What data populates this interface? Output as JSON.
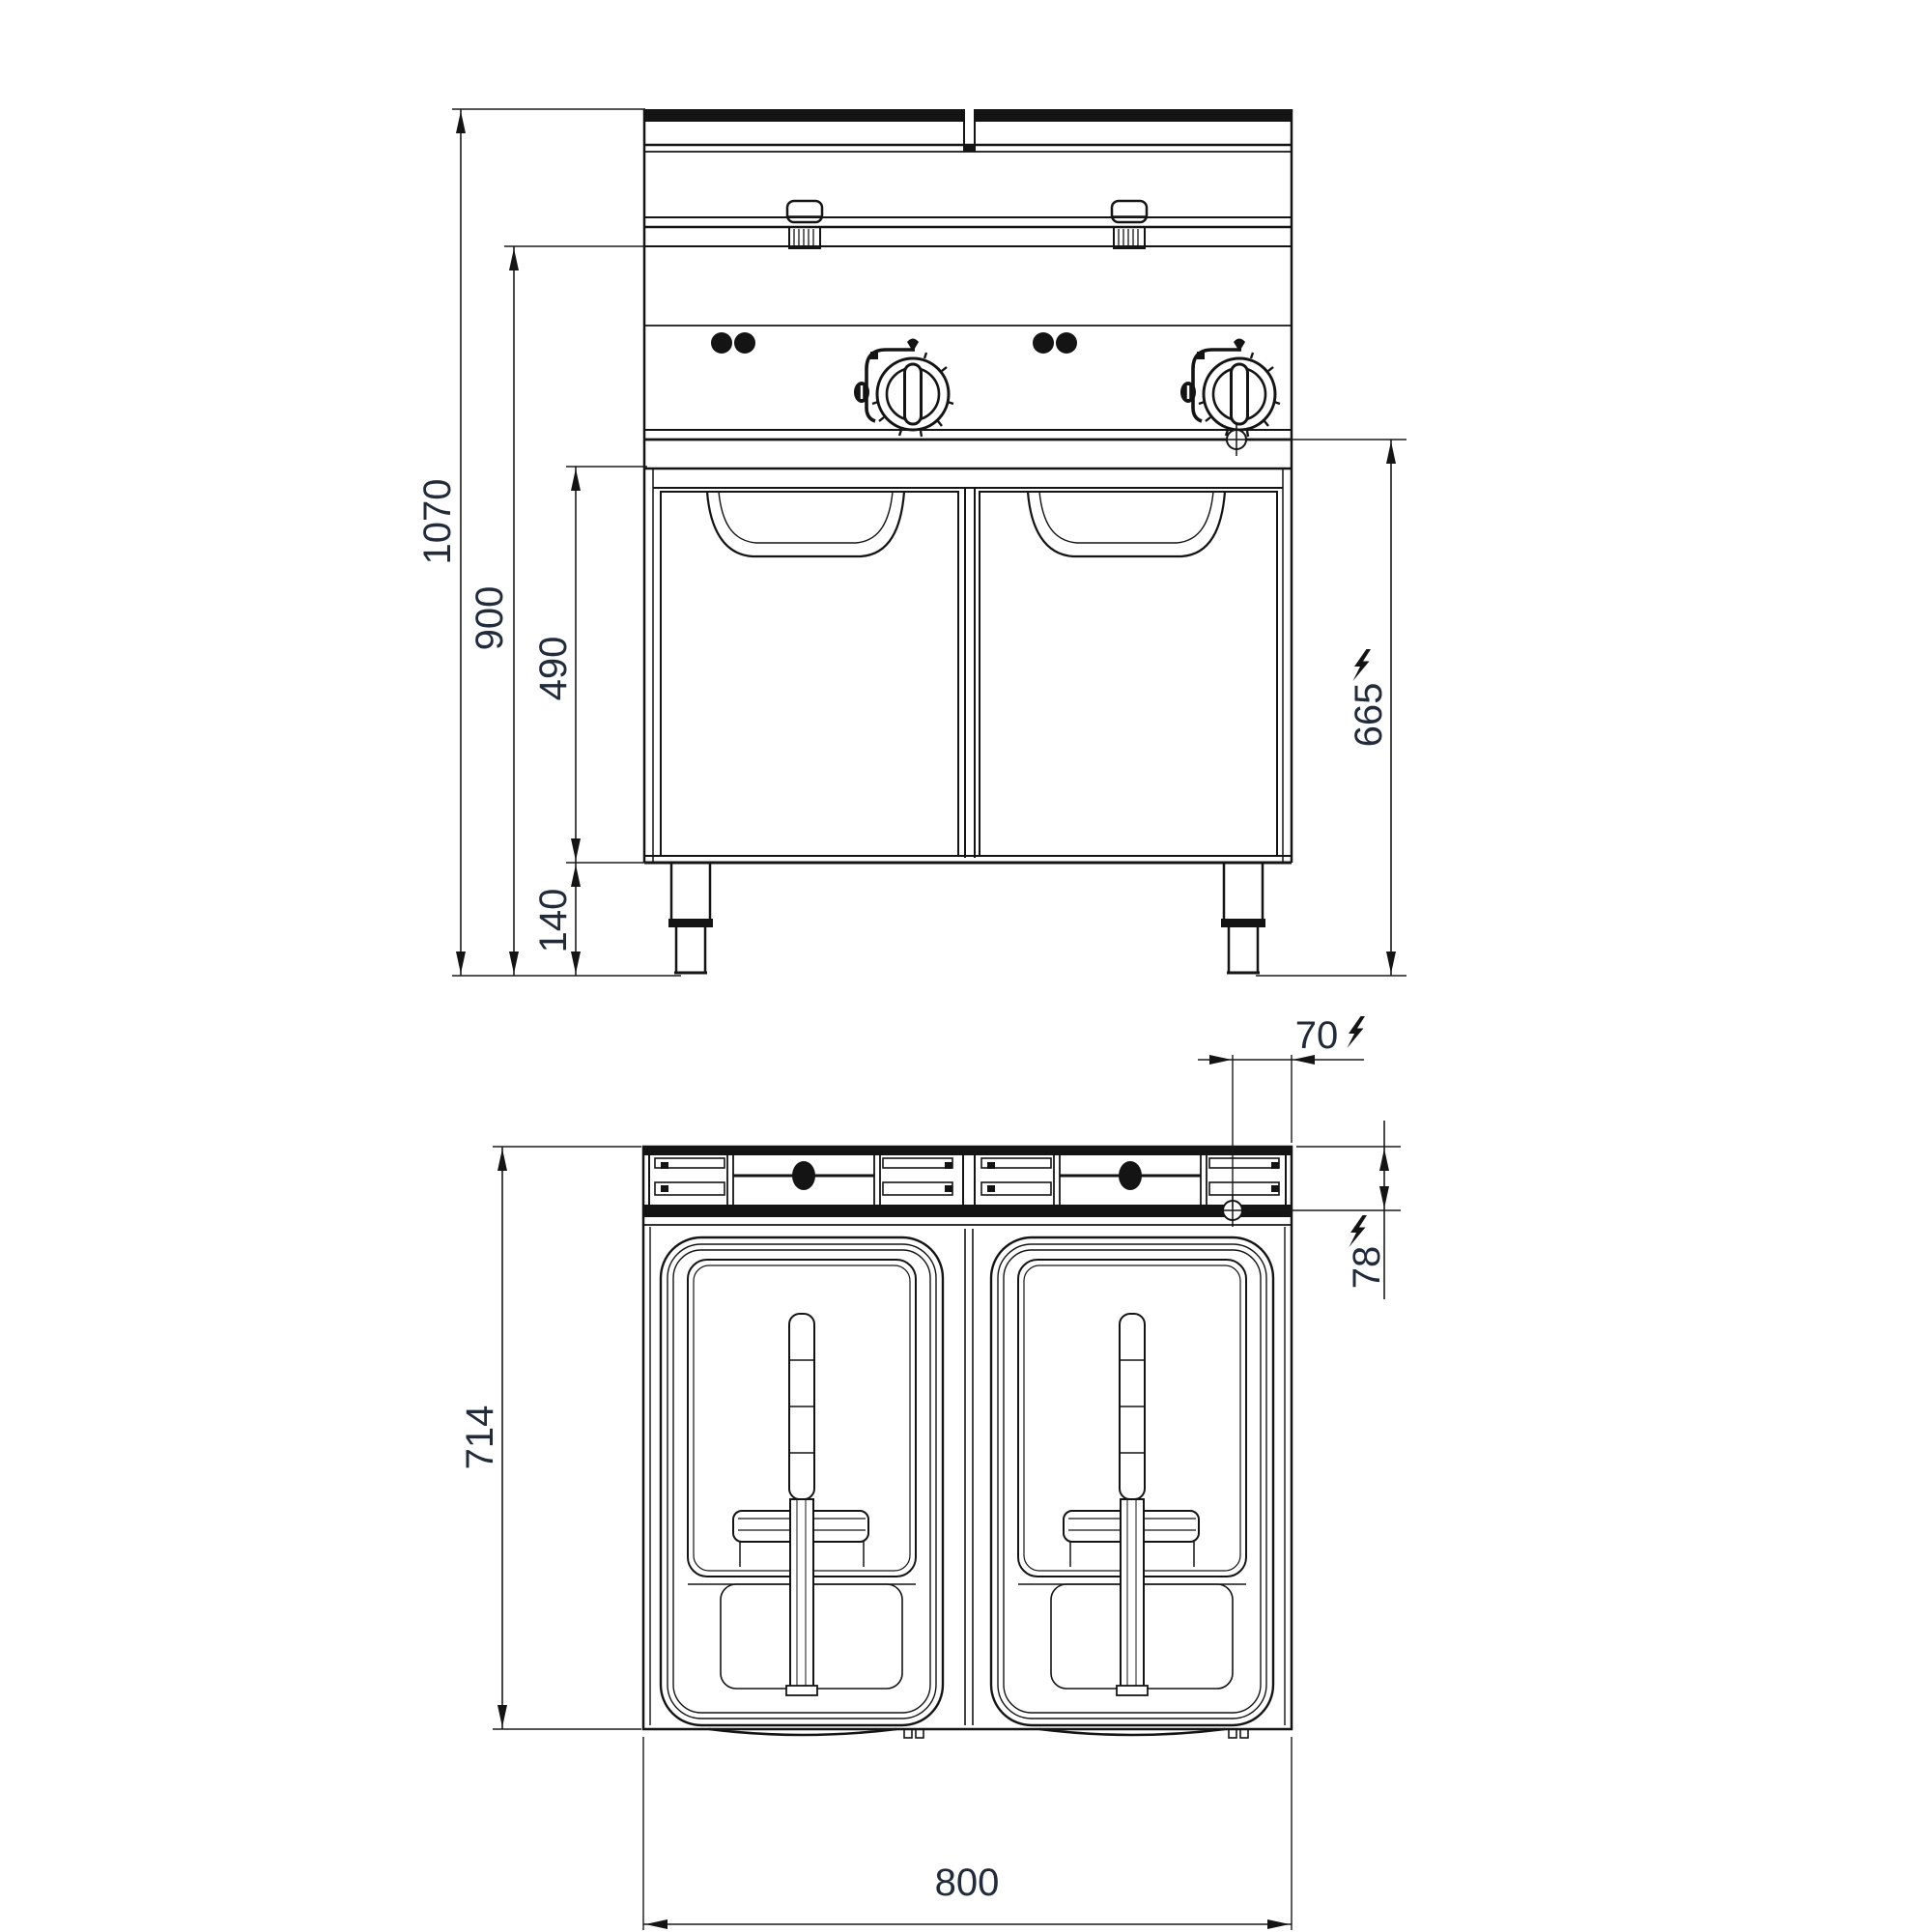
{
  "canvas": {
    "background": "#ffffff",
    "line_color": "#141414",
    "dim_text_color": "#222b3a"
  },
  "dimensions": {
    "front_view": {
      "overall_height": "1070",
      "working_height": "900",
      "cabinet_height": "490",
      "leg_height": "140",
      "electrical_connection_height": "665"
    },
    "top_view": {
      "depth": "714",
      "width": "800",
      "electrical_offset_from_right": "70",
      "electrical_offset_from_back": "78"
    }
  },
  "icons": {
    "lightning": "electric-connection",
    "crosshair": "electrical-connection-point"
  }
}
